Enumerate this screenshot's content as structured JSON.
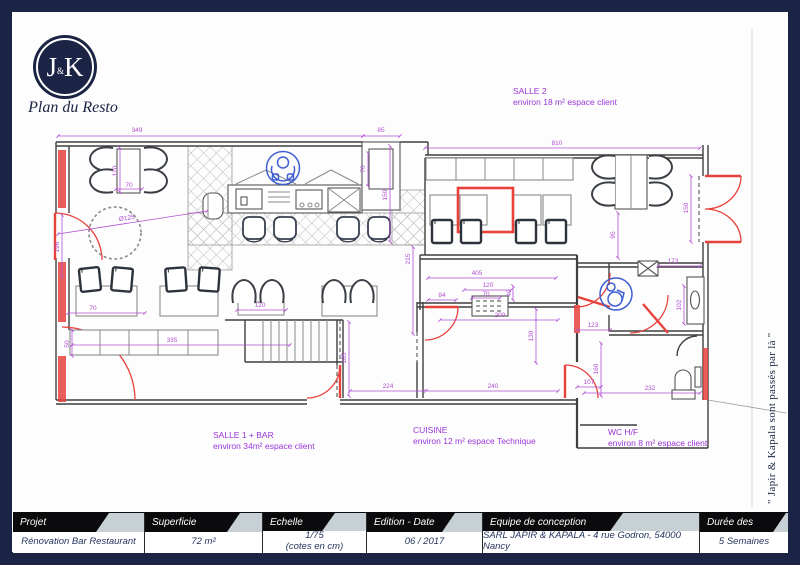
{
  "branding": {
    "logo_j": "J",
    "logo_amp": "&",
    "logo_k": "K",
    "tagline": "Plan du Resto"
  },
  "side_note": "\" Japir & Kapala sont passés par là \"",
  "rooms": [
    {
      "name": "SALLE 2",
      "info": "environ 18 m² espace client"
    },
    {
      "name": "SALLE 1 + BAR",
      "info": "environ 34m² espace client"
    },
    {
      "name": "CUISINE",
      "info": "environ 12 m² espace Technique"
    },
    {
      "name": "WC H/F",
      "info": "environ 8 m² espace client"
    }
  ],
  "dims": [
    "349",
    "85",
    "810",
    "120",
    "70",
    "Ø125",
    "196",
    "70",
    "50",
    "335",
    "120",
    "185",
    "224",
    "240",
    "405",
    "84",
    "120",
    "70",
    "40",
    "200",
    "130",
    "123",
    "160",
    "107",
    "232",
    "173",
    "102",
    "95",
    "150",
    "70",
    "150",
    "215"
  ],
  "title_block": {
    "columns": [
      {
        "header": "Projet",
        "value": "Rénovation Bar Restaurant"
      },
      {
        "header": "Superficie",
        "value": "72  m²"
      },
      {
        "header": "Echelle",
        "value": "1/75",
        "value2": "(cotes en cm)"
      },
      {
        "header": "Edition - Date",
        "value": "06 / 2017"
      },
      {
        "header": "Equipe de conception",
        "value": "SARL JAPIR & KAPALA - 4 rue Godron, 54000 Nancy"
      },
      {
        "header": "Durée des travaux",
        "value": "5 Semaines"
      }
    ]
  },
  "colors": {
    "navy": "#1b2444",
    "dimension": "#b14fd2",
    "label": "#9a35d6",
    "modification_red": "#e8413c",
    "icon_blue": "#3f5fd0",
    "header_bg": "#c7d0d5",
    "banner": "#0b0b0d"
  }
}
